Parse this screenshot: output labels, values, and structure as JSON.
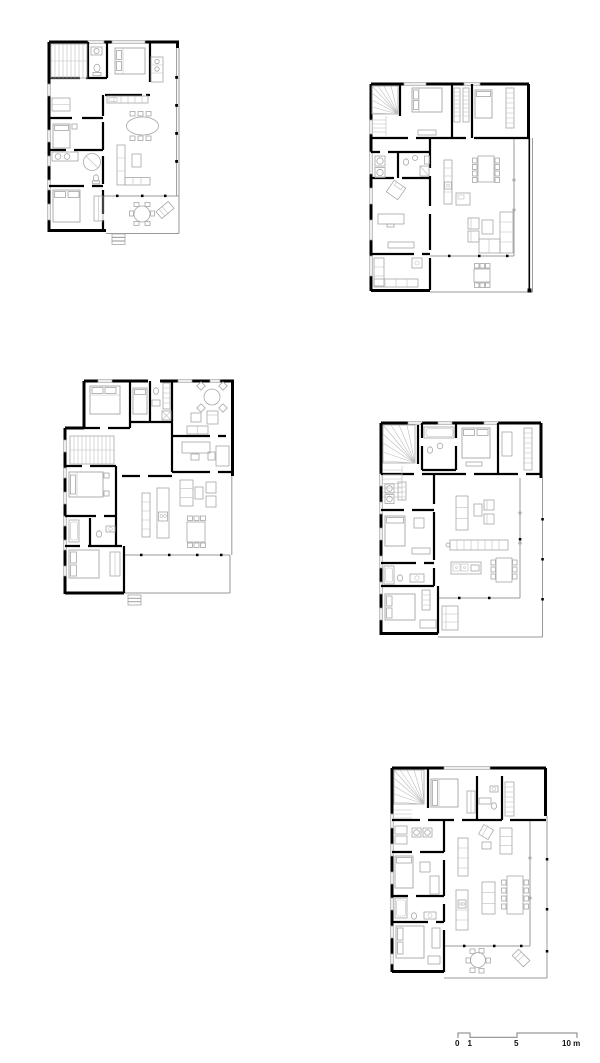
{
  "page": {
    "background_color": "#ffffff"
  },
  "drawing": {
    "type": "architectural floor plans",
    "plan_count": 5,
    "colors": {
      "wall": "#000000",
      "furniture_line": "#a6a6a6",
      "glazing_line": "#9a9a9a",
      "stair_line": "#bdbdbd",
      "background": "#ffffff"
    },
    "plans": [
      {
        "name": "floor-plan-top-left"
      },
      {
        "name": "floor-plan-top-right"
      },
      {
        "name": "floor-plan-middle-left"
      },
      {
        "name": "floor-plan-middle-right"
      },
      {
        "name": "floor-plan-bottom-right"
      }
    ]
  },
  "scale_bar": {
    "ticks": [
      {
        "label": "0"
      },
      {
        "label": "1"
      },
      {
        "label": "5"
      },
      {
        "label": "10 m"
      }
    ]
  }
}
